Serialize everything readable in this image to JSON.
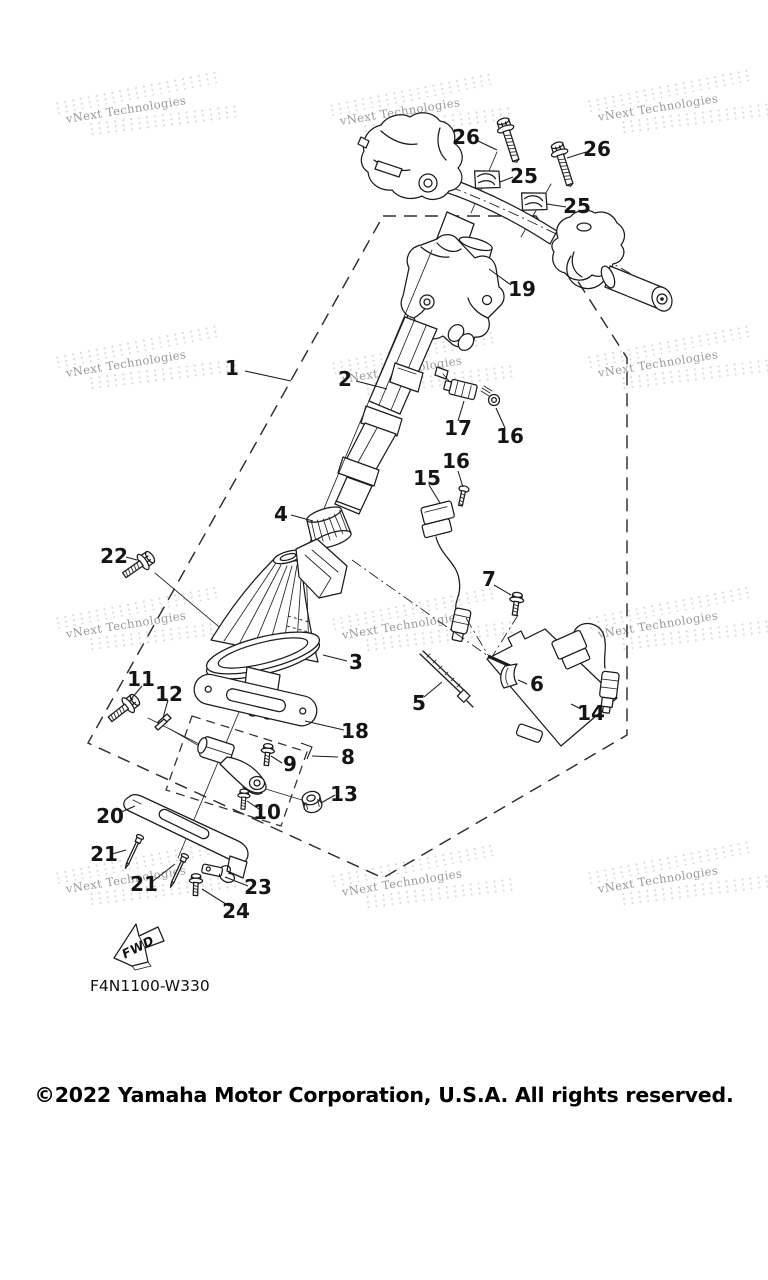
{
  "diagram": {
    "part_code": "F4N1100-W330",
    "copyright": "©2022 Yamaha Motor Corporation, U.S.A. All rights reserved.",
    "fwd_label": "FWD",
    "watermark_text": "vNext Technologies",
    "callouts": [
      {
        "id": "26-left",
        "label": "26"
      },
      {
        "id": "26-right",
        "label": "26"
      },
      {
        "id": "25-upper",
        "label": "25"
      },
      {
        "id": "25-lower",
        "label": "25"
      },
      {
        "id": "19",
        "label": "19"
      },
      {
        "id": "1",
        "label": "1"
      },
      {
        "id": "2",
        "label": "2"
      },
      {
        "id": "17",
        "label": "17"
      },
      {
        "id": "16-upper",
        "label": "16"
      },
      {
        "id": "16-mid",
        "label": "16"
      },
      {
        "id": "15",
        "label": "15"
      },
      {
        "id": "4",
        "label": "4"
      },
      {
        "id": "22",
        "label": "22"
      },
      {
        "id": "7",
        "label": "7"
      },
      {
        "id": "3",
        "label": "3"
      },
      {
        "id": "5",
        "label": "5"
      },
      {
        "id": "6",
        "label": "6"
      },
      {
        "id": "14",
        "label": "14"
      },
      {
        "id": "11",
        "label": "11"
      },
      {
        "id": "12",
        "label": "12"
      },
      {
        "id": "18",
        "label": "18"
      },
      {
        "id": "8",
        "label": "8"
      },
      {
        "id": "9",
        "label": "9"
      },
      {
        "id": "10",
        "label": "10"
      },
      {
        "id": "13",
        "label": "13"
      },
      {
        "id": "20",
        "label": "20"
      },
      {
        "id": "21-upper",
        "label": "21"
      },
      {
        "id": "21-lower",
        "label": "21"
      },
      {
        "id": "23",
        "label": "23"
      },
      {
        "id": "24",
        "label": "24"
      }
    ]
  }
}
